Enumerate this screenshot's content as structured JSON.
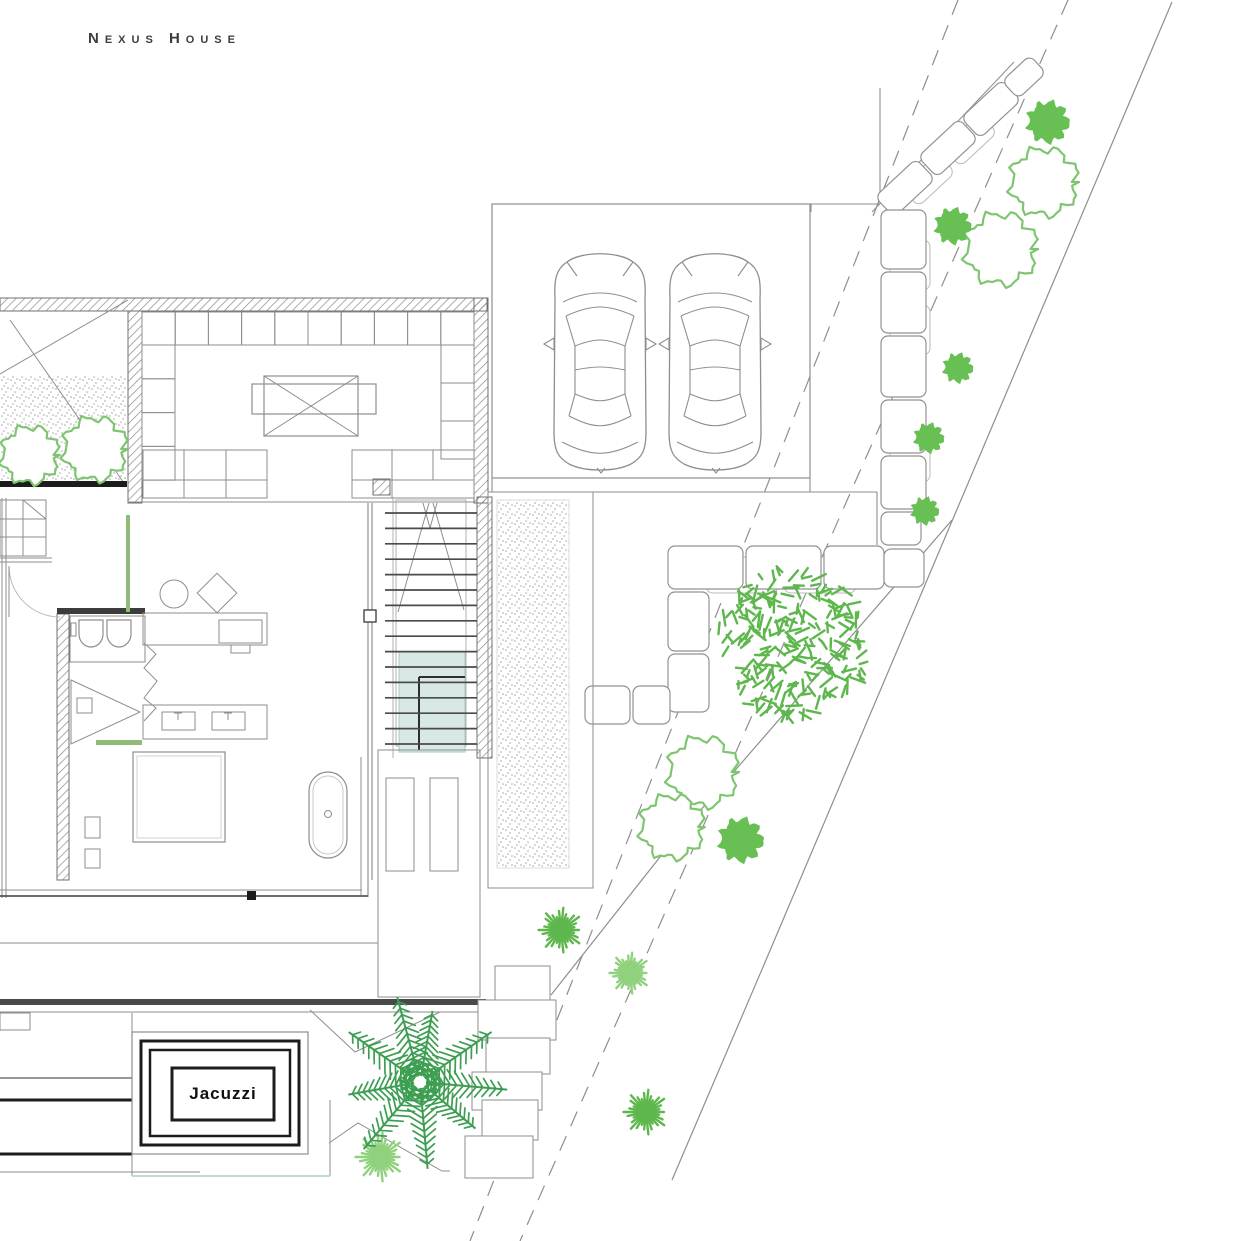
{
  "title": "Nexus House",
  "plan": {
    "jacuzzi_label": "Jacuzzi"
  },
  "colors": {
    "line": "#8e8e8e",
    "line_light": "#b9b9b9",
    "line_dark": "#3c3c3c",
    "black": "#1c1c1c",
    "wall_hatch": "#8a8a8a",
    "green_outline": "#7fc571",
    "green_solid": "#68c055",
    "green_medium": "#5eb74d",
    "green_light": "#90d17e",
    "green_palm": "#3d9e52",
    "green_accent": "#8fbc76",
    "pool_fill": "#d8e9e5",
    "pool_edge": "#a9c8c2",
    "stipple": "#a6a6a6",
    "stone": "#929292"
  }
}
